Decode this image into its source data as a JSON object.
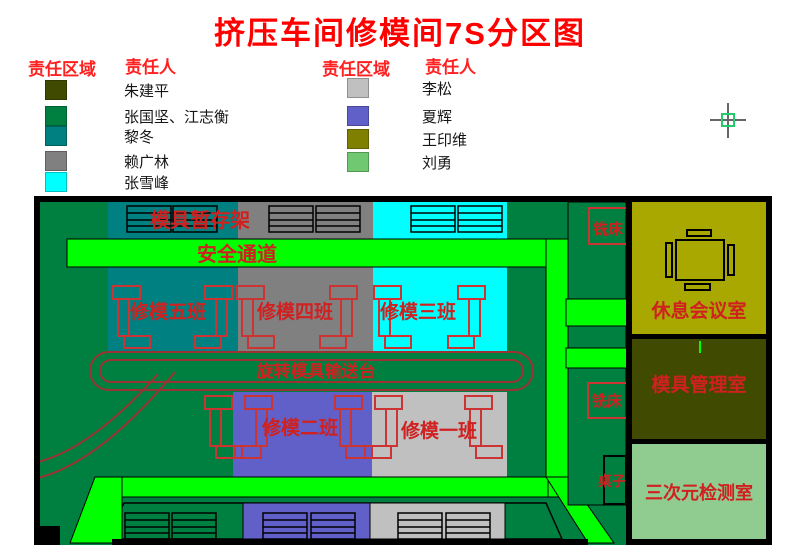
{
  "title": "挤压车间修模间7S分区图",
  "colors": {
    "title": "#FF0000",
    "legend_header": "#FF2020",
    "map_label": "#D02020"
  },
  "legend_left": {
    "header_area": "责任区域",
    "header_person": "责任人",
    "items": [
      {
        "color": "#404A00",
        "person": "朱建平"
      },
      {
        "color": "#008040",
        "person": "张国坚、江志衡"
      },
      {
        "color": "#008080",
        "person": "黎冬"
      },
      {
        "color": "#808080",
        "person": "赖广林"
      },
      {
        "color": "#00FFFF",
        "person": "张雪峰"
      }
    ]
  },
  "legend_right": {
    "header_area": "责任区域",
    "header_person": "责任人",
    "items": [
      {
        "color": "#C0C0C0",
        "person": "李松"
      },
      {
        "color": "#6060C8",
        "person": "夏辉"
      },
      {
        "color": "#808000",
        "person": "王印维"
      },
      {
        "color": "#70C870",
        "person": "刘勇"
      }
    ]
  },
  "map": {
    "floor_color": "#008040",
    "passage_color": "#00FF00",
    "zones": {
      "class5": {
        "label": "修模五班",
        "color": "#008080"
      },
      "class4": {
        "label": "修模四班",
        "color": "#808080"
      },
      "class3": {
        "label": "修模三班",
        "color": "#00FFFF"
      },
      "class2": {
        "label": "修模二班",
        "color": "#6060C8"
      },
      "class1": {
        "label": "修模一班",
        "color": "#C0C0C0"
      }
    },
    "rooms": {
      "meeting": {
        "label": "休息会议室",
        "color": "#A8A800"
      },
      "mold_mgmt": {
        "label": "模具管理室",
        "color": "#404A00"
      },
      "cmm": {
        "label": "三次元检测室",
        "color": "#90CC90"
      }
    },
    "features": {
      "storage_rack": "模具暂存架",
      "safety_channel": "安全通道",
      "conveyor": "旋转模具输送台",
      "milling_1": "铣床",
      "milling_2": "铣床",
      "desk": "桌子"
    }
  }
}
